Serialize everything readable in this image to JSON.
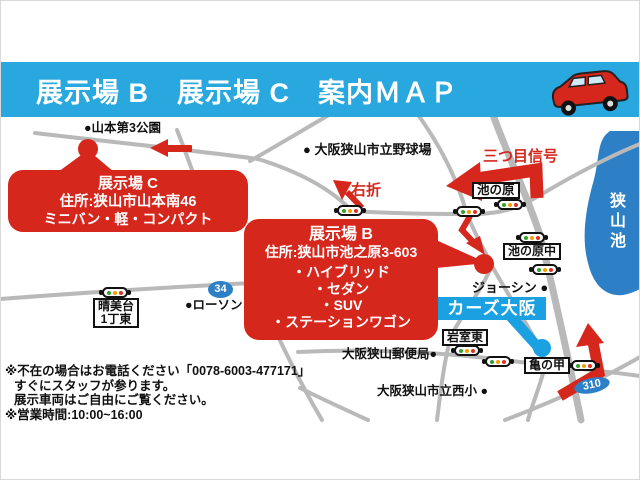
{
  "header": {
    "title": "展示場 B　展示場 C　案内ＭＡＰ",
    "car_icon": "red-minivan"
  },
  "map": {
    "callout_b": {
      "title": "展示場 B",
      "address": "住所:狭山市池之原3-603",
      "items": [
        "・ハイブリッド",
        "・セダン",
        "・SUV",
        "・ステーションワゴン"
      ]
    },
    "callout_c": {
      "title": "展示場 C",
      "address": "住所:狭山市山本南46",
      "note": "ミニバン・軽・コンパクト"
    },
    "labels": {
      "park": "●山本第3公園",
      "stadium": "● 大阪狭山市立野球場",
      "third_signal": "三つ目信号",
      "right_turn": "右折",
      "ikenohara": "池の原",
      "ikenohara_naka": "池の原中",
      "joshin": "ジョーシン ●",
      "cars_osaka": "カーズ大阪",
      "harumidai_line1": "晴美台",
      "harumidai_line2": "1丁東",
      "lawson": "●ローソン",
      "route34": "34",
      "route310": "310",
      "iwamuro_higashi": "岩室東",
      "post_office": "大阪狭山郵便局●",
      "kamenoko": "亀の甲",
      "nishi_elementary": "大阪狭山市立西小 ●",
      "sayama_lake": "狭山池"
    },
    "colors": {
      "accent_red": "#d6271d",
      "header_blue": "#29a8e0",
      "lake_blue": "#2d7fc6",
      "shop_badge_blue": "#1ba1e2",
      "road_gray": "#b9b9b9"
    }
  },
  "footer": {
    "lines": [
      "※不在の場合はお電話ください「0078-6003-477171」",
      "すぐにスタッフが参ります。",
      "展示車両はご自由にご覧ください。",
      "※営業時間:10:00~16:00"
    ]
  }
}
